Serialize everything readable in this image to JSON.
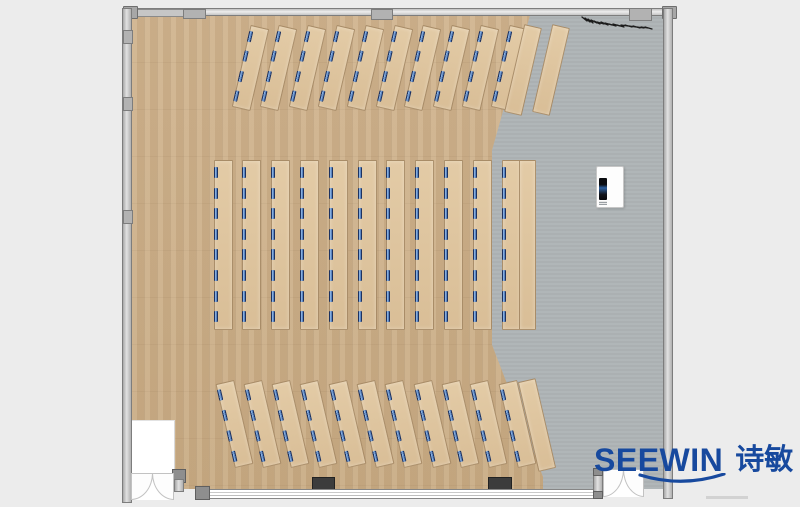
{
  "brand": {
    "latin": "SEEWIN",
    "cn": "诗敏",
    "color": "#17499E"
  },
  "colors": {
    "background": "#ECECEC",
    "wood_floor": "#CDB18C",
    "gray_floor": "#AEB4B6",
    "desk": "#E0C6A1",
    "monitor_dark": "#1D3260",
    "monitor_light": "#86AEDE",
    "wall": "#C9C9C9",
    "column_block": "#3C3C3C"
  },
  "desk_sections": [
    {
      "id": "top-angled-rows",
      "count": 10,
      "marks": 4,
      "rotation": 13,
      "cx0": 249,
      "cy": 67,
      "dx": 28.8,
      "w": 17,
      "h": 82,
      "mark_y0": 5,
      "mark_dy": 20.4
    },
    {
      "id": "top-side-tables",
      "count": 2,
      "marks": 0,
      "rotation": 13,
      "cx0": 522,
      "cy": 69,
      "dx": 28,
      "w": 16,
      "h": 88,
      "mark_y0": 0,
      "mark_dy": 0
    },
    {
      "id": "middle-columns",
      "count": 11,
      "marks": 8,
      "rotation": 0,
      "cx0": 222,
      "cy": 244,
      "dx": 28.8,
      "w": 17,
      "h": 168,
      "mark_y0": 6,
      "mark_dy": 20.6
    },
    {
      "id": "middle-side-table",
      "count": 1,
      "marks": 0,
      "rotation": 0,
      "cx0": 526,
      "cy": 244,
      "dx": 0,
      "w": 15,
      "h": 168,
      "mark_y0": 0,
      "mark_dy": 0
    },
    {
      "id": "bottom-angled-rows",
      "count": 11,
      "marks": 4,
      "rotation": -13,
      "cx0": 233,
      "cy": 423,
      "dx": 28.3,
      "w": 17,
      "h": 84,
      "mark_y0": 5,
      "mark_dy": 21
    },
    {
      "id": "bottom-side-table",
      "count": 1,
      "marks": 0,
      "rotation": -13,
      "cx0": 536,
      "cy": 424,
      "dx": 0,
      "w": 16,
      "h": 90,
      "mark_y0": 0,
      "mark_dy": 0
    }
  ]
}
